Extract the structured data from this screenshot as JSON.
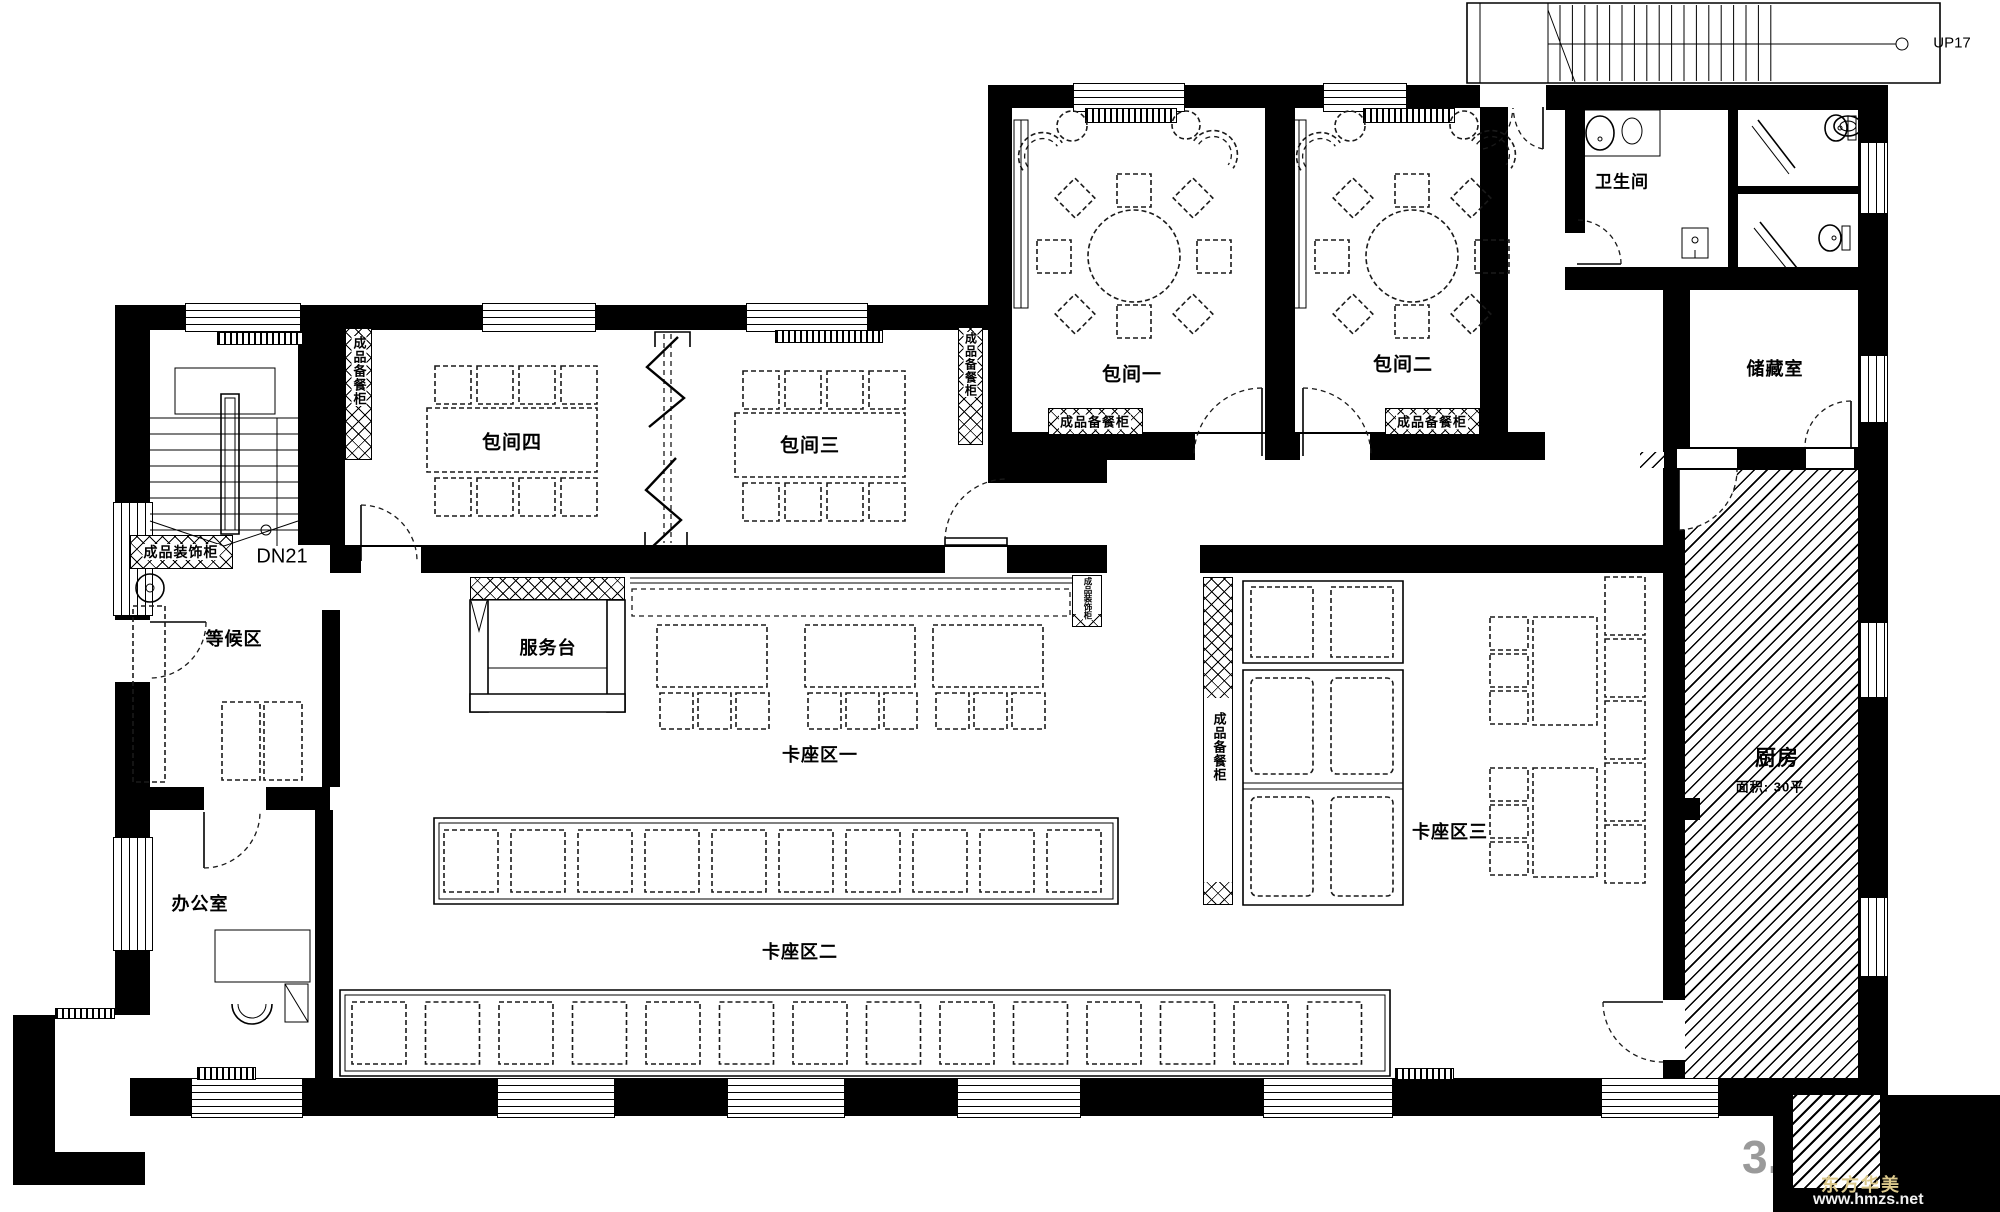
{
  "plan": {
    "rooms": {
      "private_room_1": "包间一",
      "private_room_2": "包间二",
      "private_room_3": "包间三",
      "private_room_4": "包间四",
      "bathroom": "卫生间",
      "storage_room": "储藏室",
      "kitchen_name": "厨房",
      "kitchen_area": "面积: 30平",
      "waiting_area": "等候区",
      "office": "办公室",
      "service_desk": "服务台",
      "booth_area_1": "卡座区一",
      "booth_area_2": "卡座区二",
      "booth_area_3": "卡座区三"
    },
    "stairs": {
      "up": "UP17",
      "down": "DN21"
    },
    "cabinets": {
      "prepared_food_cabinet": "成品备餐柜",
      "finished_decor_cabinet": "成品装饰柜"
    }
  },
  "watermark": {
    "number": "3.",
    "brand": "东方华美",
    "website": "www.hmzs.net"
  },
  "colors": {
    "ink": "#000000",
    "background": "#ffffff",
    "watermark_gray": "#9a9a9a",
    "brand_gold": "#dcc98c"
  }
}
